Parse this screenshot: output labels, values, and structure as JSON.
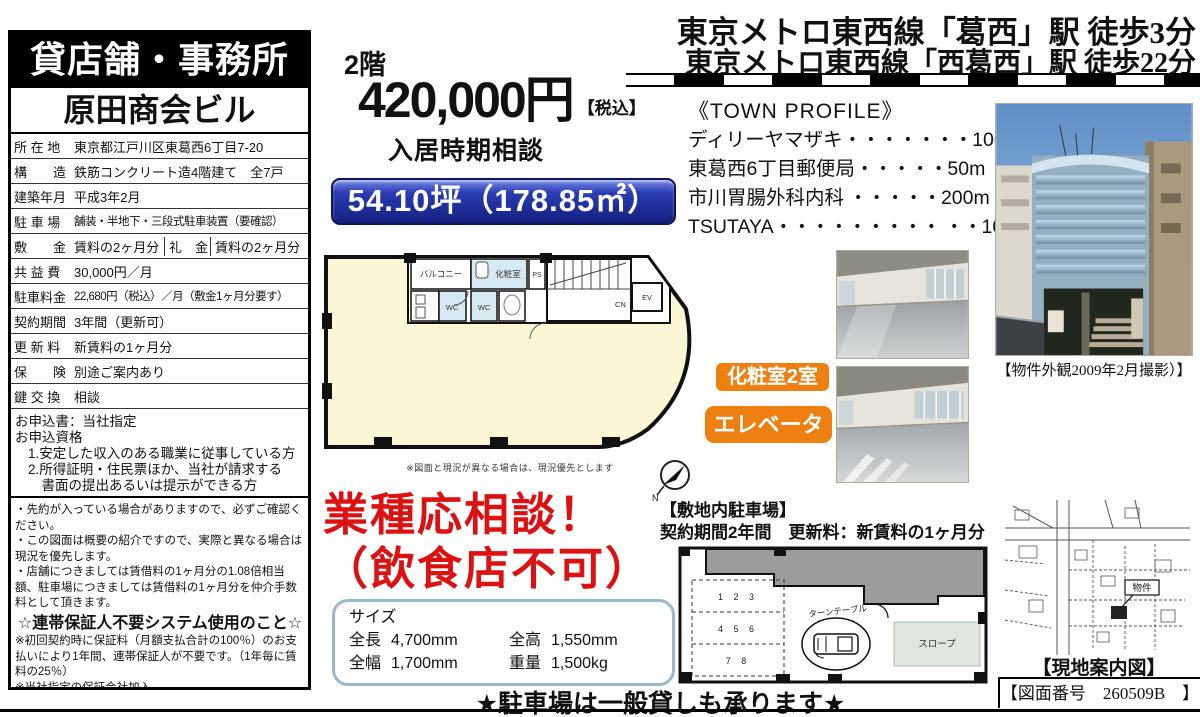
{
  "colors": {
    "banner_blue": "#1c2a9e",
    "badge_orange": "#ee8012",
    "alert_red": "#dd1111",
    "plan_cream": "#fbf6d4",
    "plan_room_blue": "#d6eaf3"
  },
  "left_panel": {
    "header": "貸店舗・事務所",
    "building_name": "原田商会ビル",
    "rows": [
      {
        "label": "所 在 地",
        "value": "東京都江戸川区東葛西6丁目7-20"
      },
      {
        "label": "構　　造",
        "value": "鉄筋コンクリート造4階建て　全7戸"
      },
      {
        "label": "建築年月",
        "value": "平成3年2月"
      },
      {
        "label": "駐 車 場",
        "value": "舗装・半地下・三段式駐車装置（要確認）"
      },
      {
        "label": "敷　　金",
        "value": "賃料の2ヶ月分",
        "label2": "礼　金",
        "value2": "賃料の2ヶ月分"
      },
      {
        "label": "共 益 費",
        "value": "30,000円／月"
      },
      {
        "label": "駐車料金",
        "value": "22,680円（税込）／月（敷金1ヶ月分要す）"
      },
      {
        "label": "契約期間",
        "value": "3年間（更新可）"
      },
      {
        "label": "更 新 料",
        "value": "新賃料の1ヶ月分"
      },
      {
        "label": "保　　険",
        "value": "別途ご案内あり"
      },
      {
        "label": "鍵 交 換",
        "value": "相談"
      }
    ],
    "application": [
      "お申込書：当社指定",
      "お申込資格",
      "1.安定した収入のある職業に従事している方",
      "2.所得証明・住民票ほか、当社が請求する",
      "　書面の提出あるいは提示ができる方"
    ],
    "notes": [
      "・先約が入っている場合がありますので、必ずご確認ください。",
      "・この図面は概要の紹介ですので、実際と異なる場合は現況を優先します。",
      "・店舗につきましては賃借料の1ヶ月分の1.08倍相当額、駐車場につきましては賃借料の1ヶ月分を仲介手数料として頂きます。"
    ],
    "guarantor_title": "☆連帯保証人不要システム使用のこと☆",
    "guarantor_notes": [
      "※初回契約時に保証料（月額支払合計の100％）のお支払いにより1年間、連帯保証人が不要です。（1年毎に賃料の25％）",
      "※当社指定の保証会社加入。"
    ]
  },
  "main": {
    "floor_label": "2階",
    "price": "420,000円",
    "price_tax": "【税込】",
    "move_in": "入居時期相談",
    "area_banner": "54.10坪（178.85㎡）",
    "floorplan": {
      "balcony": "バルコニー",
      "wc": "WC",
      "wc2": "WC",
      "powder": "化粧室",
      "ps": "PS",
      "cn": "CN",
      "ev": "EV",
      "compass_n": "N",
      "note": "※図面と現況が異なる場合は、現況優先とします"
    },
    "business_line1": "業種応相談！",
    "business_line2": "（飲食店不可）",
    "size_box": {
      "title": "サイズ",
      "r1c1": "全長",
      "r1v1": "4,700mm",
      "r1c2": "全高",
      "r1v2": "1,550mm",
      "r2c1": "全幅",
      "r2v1": "1,700mm",
      "r2c2": "重量",
      "r2v2": "1,500kg"
    },
    "parking_general": "★駐車場は一般貸しも承ります★"
  },
  "right_panel": {
    "station_line1": "東京メトロ東西線「葛西」駅 徒歩3分",
    "station_line2": "東京メトロ東西線「西葛西」駅 徒歩22分",
    "town_profile": {
      "title": "《TOWN PROFILE》",
      "items": [
        {
          "name": "ディリーヤマザキ",
          "leader": "・・・・・・・",
          "distance": "100m"
        },
        {
          "name": "東葛西6丁目郵便局",
          "leader": "・・・・・",
          "distance": "50m"
        },
        {
          "name": "市川胃腸外科内科",
          "leader": " ・・・・・",
          "distance": "200m"
        },
        {
          "name": "TSUTAYA",
          "leader": "・・・・・・・・・ ・・",
          "distance": "100m"
        }
      ]
    },
    "exterior_caption": "【物件外観2009年2月撮影）】",
    "badge_powder": "化粧室2室",
    "badge_elevator": "エレベーター",
    "parking": {
      "title": "【敷地内駐車場】",
      "terms": "契約期間2年間　更新料：新賃料の1ヶ月分",
      "row1": "1 2 3",
      "row2": "4 5 6",
      "row3": "7 8",
      "turntable": "ターンテーブル",
      "slope": "スロープ"
    },
    "map_label": "物件",
    "map_caption": "【現地案内図】",
    "drawing_no": "【図面番号　260509B　】"
  }
}
